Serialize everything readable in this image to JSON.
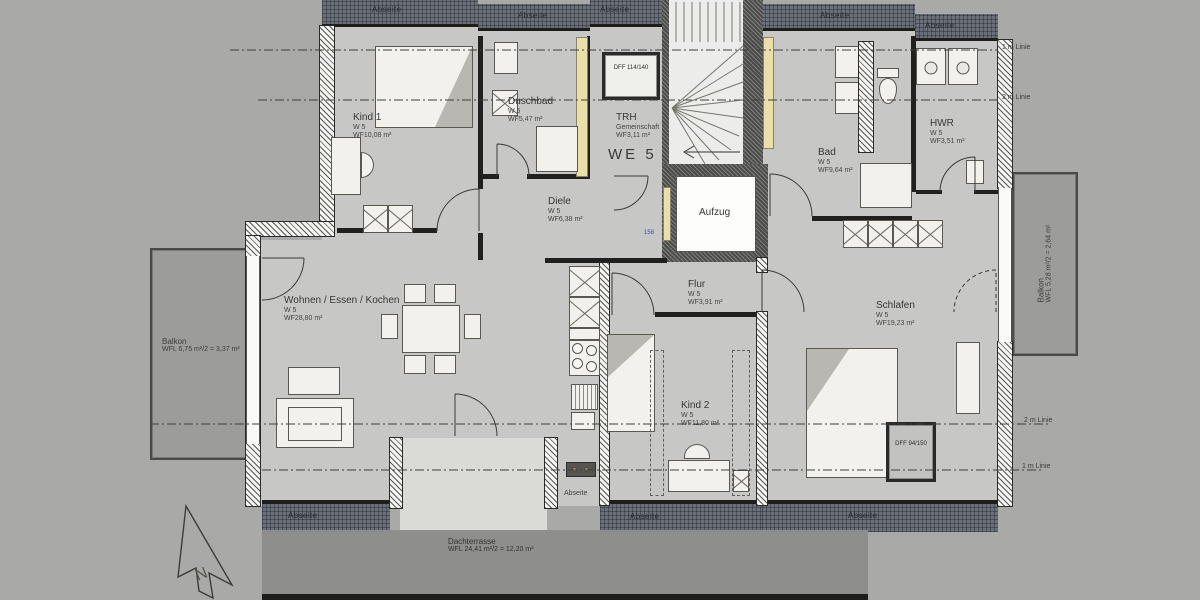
{
  "plan": {
    "unit": "WE 5",
    "north": "N",
    "abseite": "Abseite",
    "elevator_door_width": "158",
    "rooms": {
      "kind1": {
        "name": "Kind 1",
        "unit": "W 5",
        "area": "WF10,08 m²"
      },
      "duschbad": {
        "name": "Duschbad",
        "unit": "W 5",
        "area": "WF5,47 m²"
      },
      "trh": {
        "name": "TRH",
        "unit": "Gemeinschaft",
        "area": "WF3,11 m²"
      },
      "bad": {
        "name": "Bad",
        "unit": "W 5",
        "area": "WF9,64 m²"
      },
      "hwr": {
        "name": "HWR",
        "unit": "W 5",
        "area": "WF3,51 m²"
      },
      "diele": {
        "name": "Diele",
        "unit": "W 5",
        "area": "WF6,38 m²"
      },
      "aufzug": {
        "name": "Aufzug"
      },
      "flur": {
        "name": "Flur",
        "unit": "W 5",
        "area": "WF3,91 m²"
      },
      "wohnen": {
        "name": "Wohnen / Essen / Kochen",
        "unit": "W 5",
        "area": "WF28,80 m²"
      },
      "kind2": {
        "name": "Kind 2",
        "unit": "W 5",
        "area": "WF11,80 m²"
      },
      "schlafen": {
        "name": "Schlafen",
        "unit": "W 5",
        "area": "WF19,23 m²"
      }
    },
    "outdoor": {
      "balkon_left": {
        "name": "Balkon",
        "area": "WFL 6,75 m²/2 = 3,37 m²"
      },
      "balkon_right": {
        "name": "Balkon",
        "area": "WFL 5,28 m²/2 = 2,64 m²"
      },
      "dachterrasse": {
        "name": "Dachterrasse",
        "area": "WFL 24,41 m²/2 = 12,20 m²"
      }
    },
    "roof_windows": {
      "dff1": "DFF 114/140",
      "dff2": "DFF 94/150"
    },
    "height_lines": {
      "one_m": "1 m Linie",
      "two_m": "2 m Linie"
    },
    "colors": {
      "floor": "#c7c7c5",
      "abseite_band": "#6b7078",
      "terrace": "#8e8e8c",
      "installation_wall": "#eadfa9",
      "marking_blue": "#3946c8"
    }
  }
}
